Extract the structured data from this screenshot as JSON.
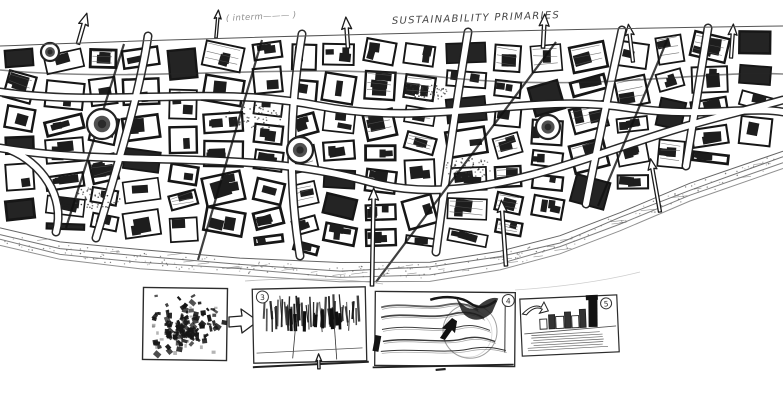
{
  "annotations": {
    "top_left": "( interm——— )",
    "top_right": "SUSTAINABILITY PRIMARIES"
  },
  "thumbnails": [
    {
      "name": "figure-ground-plan",
      "badge": ""
    },
    {
      "name": "tower-section-sketch",
      "badge": "3"
    },
    {
      "name": "landscape-flows-sketch",
      "badge": "4"
    },
    {
      "name": "waterfront-perspective-sketch",
      "badge": "5"
    }
  ],
  "palette": {
    "ink": "#1b1b1b",
    "pencil": "#777777",
    "paper": "#ffffff"
  }
}
